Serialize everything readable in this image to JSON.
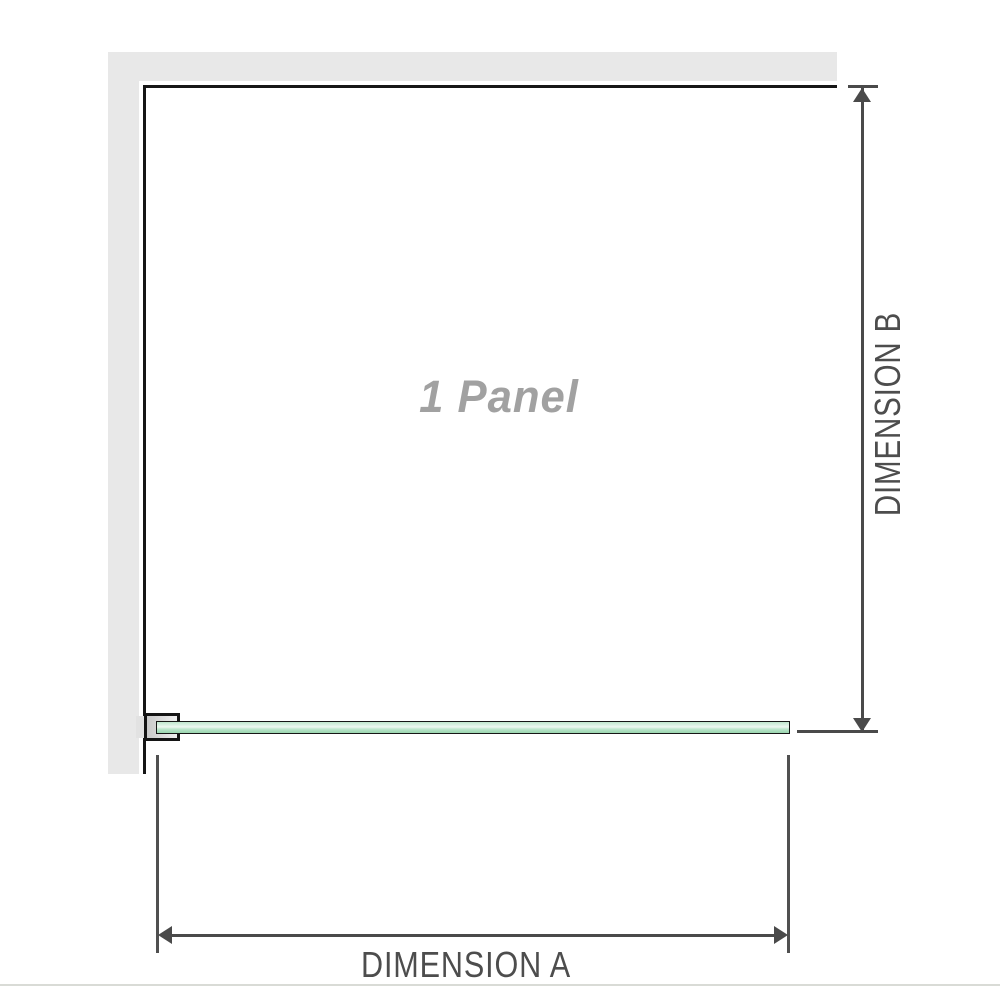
{
  "figure": {
    "panel_label": "1 Panel",
    "dim_a": {
      "label": "DIMENSION A"
    },
    "dim_b": {
      "label": "DIMENSION B"
    }
  },
  "colors": {
    "wall_fill": "#e8e8e8",
    "outline_black": "#161616",
    "dimension_gray": "#4a4a4a",
    "label_gray": "#4d4d4d",
    "panel_text_gray": "#a1a1a1",
    "glass_green_light": "#eef8f1",
    "glass_green": "#a9ddbc",
    "clamp_gray": "#d6d6d6",
    "divider_gray": "#d9dbd6"
  }
}
